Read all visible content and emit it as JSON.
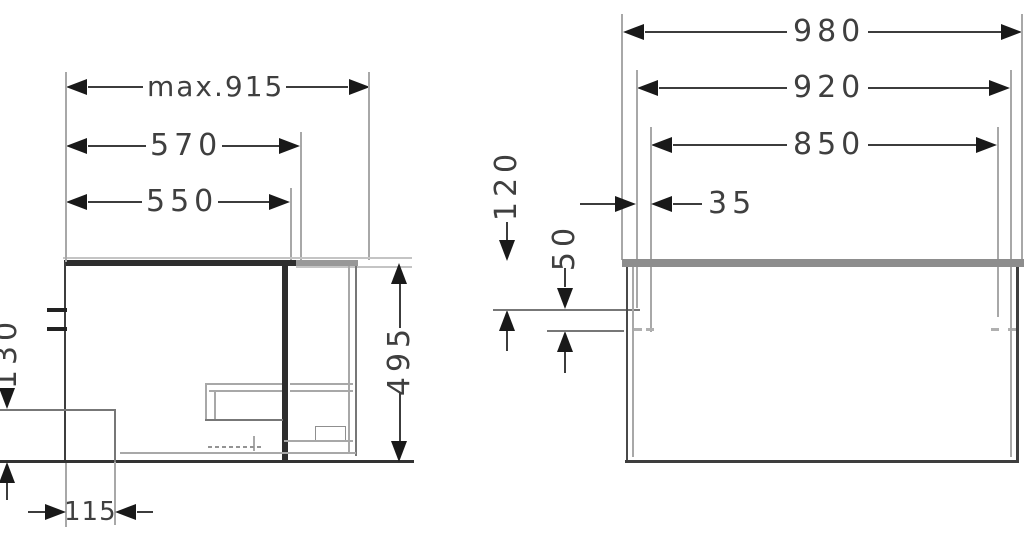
{
  "drawing": {
    "type": "technical-dimension-drawing",
    "background": "#ffffff",
    "line_color": "#3c3c3c",
    "arrow_color": "#191919",
    "text_color": "#3f3f3f",
    "countertop_color": "#8d8d8d",
    "views": {
      "side": {
        "name": "side section view of vanity unit",
        "dimensions": [
          {
            "id": "max-width",
            "label": "max.915",
            "orientation": "horizontal"
          },
          {
            "id": "depth-570",
            "label": "570",
            "orientation": "horizontal"
          },
          {
            "id": "depth-550",
            "label": "550",
            "orientation": "horizontal"
          },
          {
            "id": "height-495",
            "label": "495",
            "orientation": "vertical"
          },
          {
            "id": "cutout-130",
            "label": "130",
            "orientation": "vertical"
          },
          {
            "id": "cutout-115",
            "label": "115",
            "orientation": "horizontal"
          }
        ]
      },
      "front": {
        "name": "front view of vanity unit",
        "dimensions": [
          {
            "id": "width-980",
            "label": "980",
            "orientation": "horizontal"
          },
          {
            "id": "width-920",
            "label": "920",
            "orientation": "horizontal"
          },
          {
            "id": "width-850",
            "label": "850",
            "orientation": "horizontal"
          },
          {
            "id": "offset-35",
            "label": "35",
            "orientation": "horizontal"
          },
          {
            "id": "offset-120",
            "label": "120",
            "orientation": "vertical"
          },
          {
            "id": "offset-50",
            "label": "50",
            "orientation": "vertical"
          }
        ]
      }
    }
  }
}
